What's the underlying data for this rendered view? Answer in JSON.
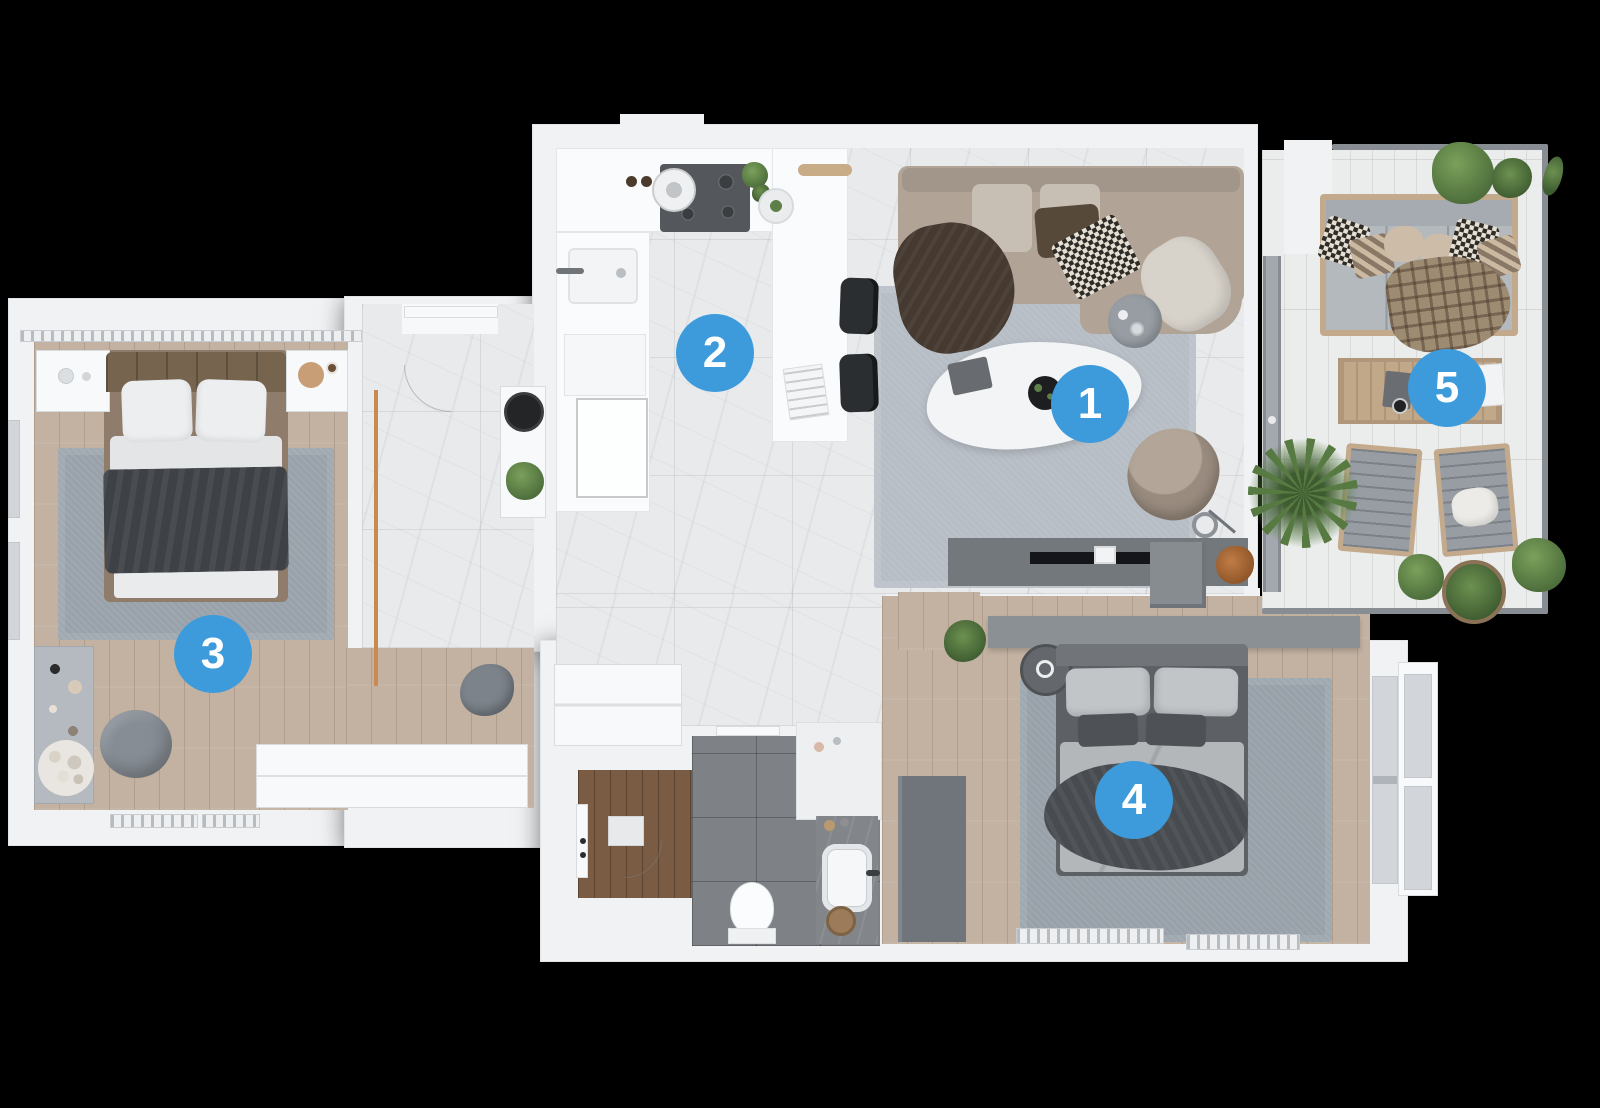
{
  "markers": [
    {
      "number": "1"
    },
    {
      "number": "2"
    },
    {
      "number": "3"
    },
    {
      "number": "4"
    },
    {
      "number": "5"
    }
  ],
  "colors": {
    "marker_background": "#3d9bdc",
    "marker_text": "#ffffff",
    "canvas_background": "#000000",
    "wall": "#f0f2f4",
    "marble_floor": "#e9eaec",
    "wood_floor": "#c3b2a2",
    "entry_wood_floor": "#7a5c44",
    "bathroom_tile": "#7e8286",
    "rug": "#99a2aa",
    "sofa": "#b1a497",
    "greenery": "#5e7f49"
  }
}
